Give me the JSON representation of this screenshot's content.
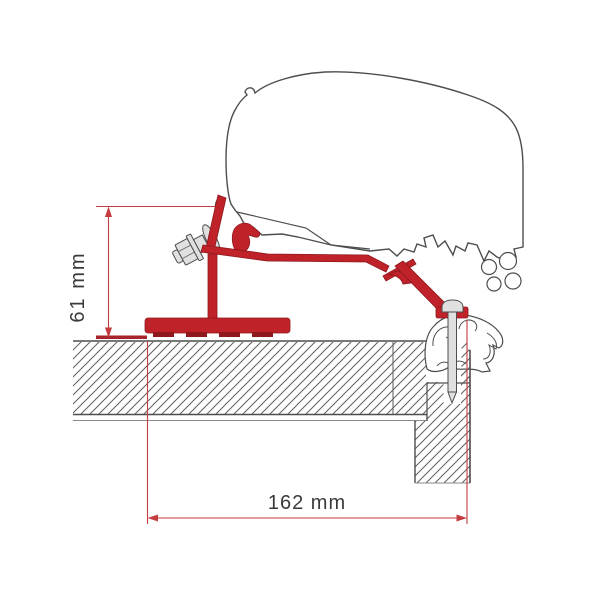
{
  "diagram": {
    "dimensions": [
      {
        "id": "bracket-height",
        "label": "61 mm",
        "value": 61,
        "unit": "mm",
        "orientation": "vertical"
      },
      {
        "id": "mounting-offset",
        "label": "162 mm",
        "value": 162,
        "unit": "mm",
        "orientation": "horizontal"
      }
    ],
    "colors": {
      "bracket_red": "#bf2229",
      "bracket_red_dark": "#8e181d",
      "dimension_red": "#c43b40",
      "outline_gray": "#4d4d4d",
      "hatch_gray": "#606060",
      "metal_light": "#e0e0e0",
      "text_gray": "#3a3a3a"
    }
  }
}
